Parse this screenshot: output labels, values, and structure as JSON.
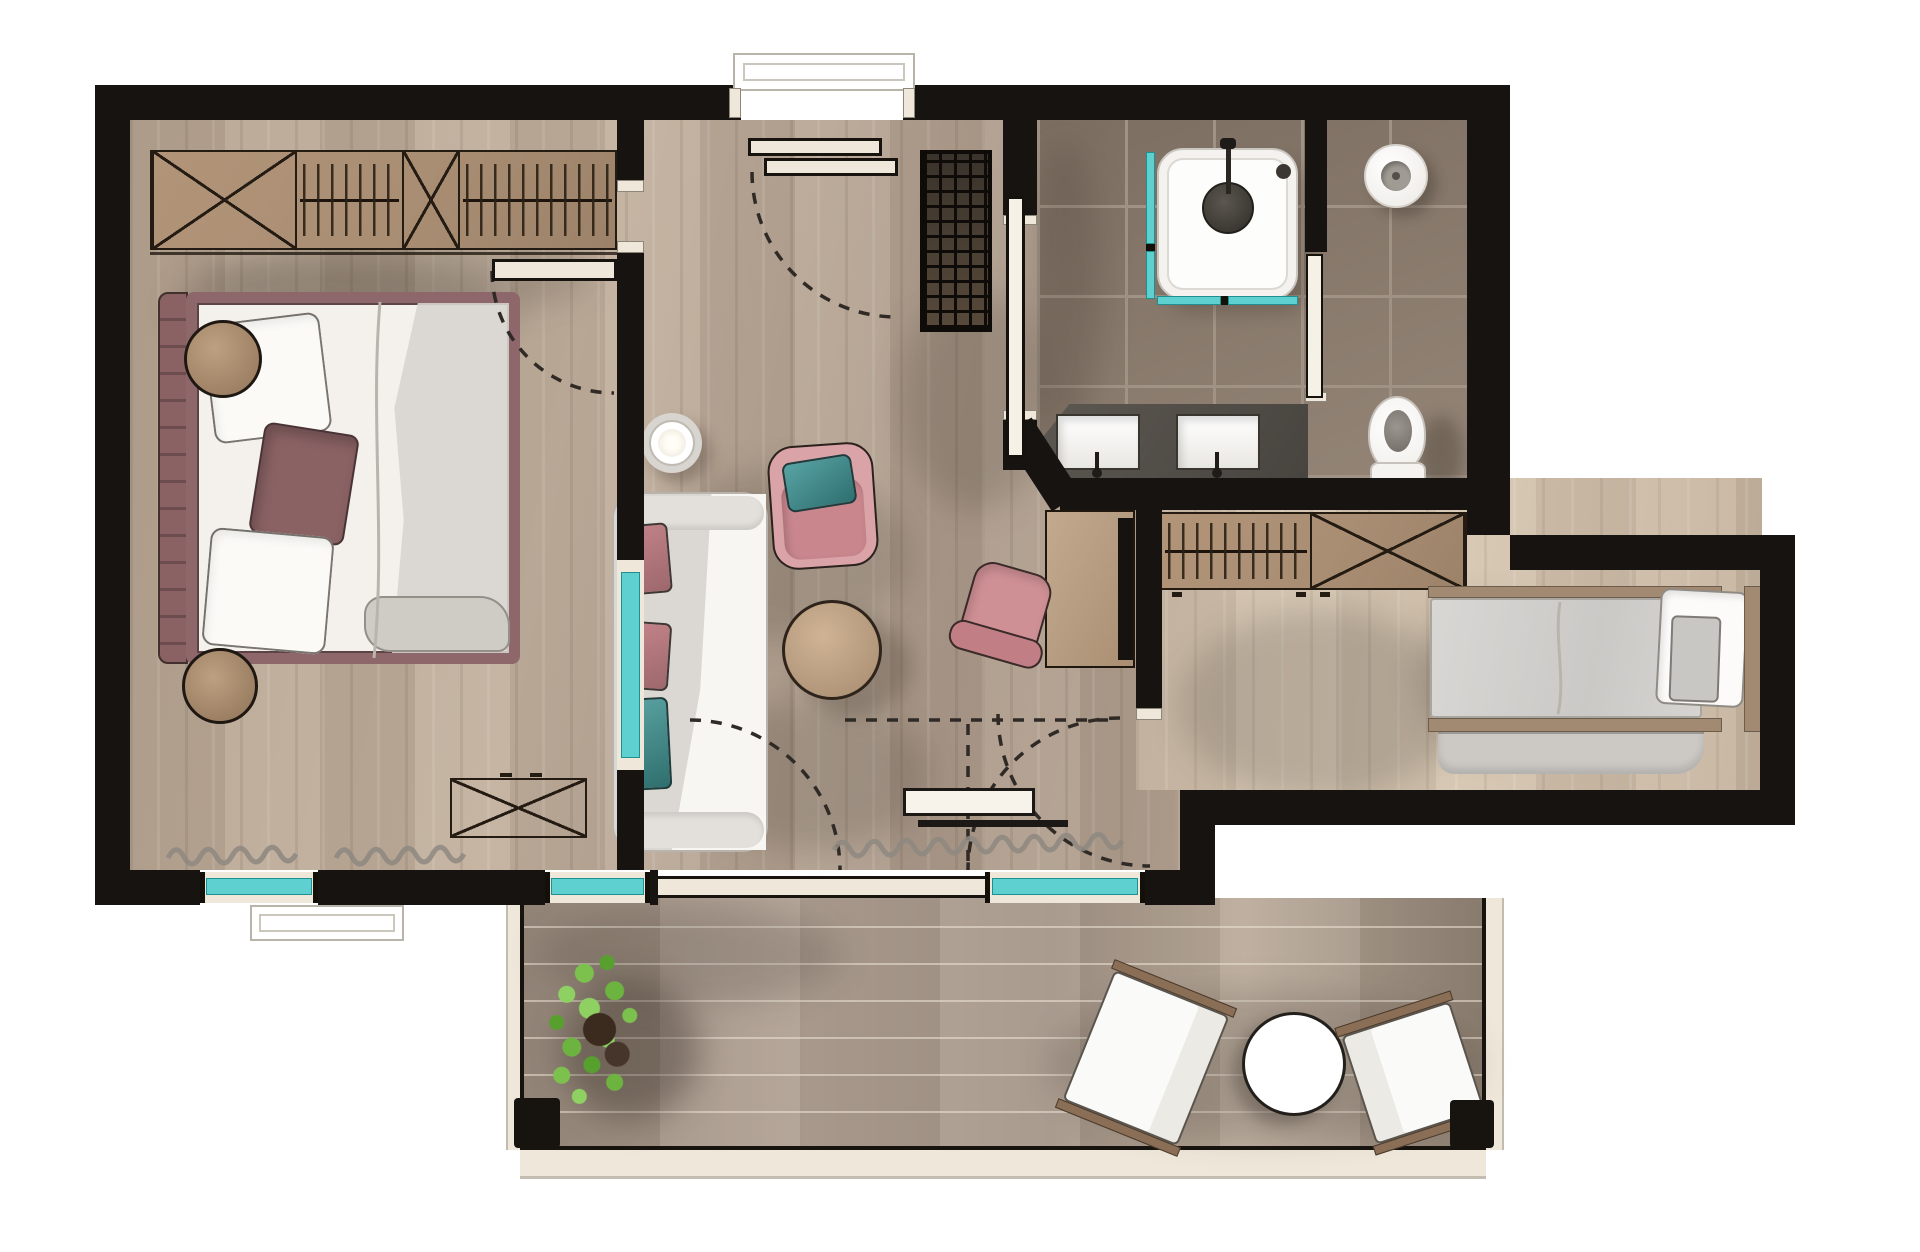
{
  "document": {
    "kind": "architectural floor plan rendering",
    "view": "top-down",
    "style": "hand-drawn watercolor sketch",
    "visible_text": ""
  },
  "palette": {
    "wall": "#171310",
    "outline": "#241c13",
    "cream": "#efe8da",
    "teal": "#5ed0d0",
    "woodFloor": "#b4a190",
    "woodFloorLight": "#cdbda9",
    "deck": "#a29386",
    "tile": "#8d7d6e",
    "tileGrout": "#a09284",
    "tan": "#aa8f75",
    "tanDark": "#8a6f56",
    "maroon": "#8a6264",
    "pink": "#d9a2a8",
    "pinkDeep": "#cf9095",
    "tealCushion": "#44898a",
    "whiteFabric": "#f7f6f3",
    "grayFabric": "#d8d5d0",
    "counterGray": "#56514b",
    "plantGreen": "#6cb94a"
  },
  "plan": {
    "rooms": [
      {
        "name": "master-bedroom",
        "floor": "wood",
        "items": [
          "wardrobe with shelves and hanger rods",
          "double bed with maroon frame",
          "white pillows",
          "maroon accent pillow",
          "round bedside stool top",
          "round bedside stool bottom",
          "dresser with X front",
          "curtain",
          "teal window"
        ]
      },
      {
        "name": "entry-hall",
        "floor": "wood",
        "items": [
          "entry door with swing arc",
          "floor grate"
        ]
      },
      {
        "name": "living-room",
        "floor": "wood",
        "items": [
          "pendant ring lamp",
          "sofa with chaise",
          "pink cushion",
          "pink cushion",
          "teal cushion",
          "round coffee table",
          "pink armchair with teal cushion",
          "desk",
          "tv on desk",
          "pink swivel desk chair",
          "sliding terrace door",
          "teal windows",
          "curtain"
        ]
      },
      {
        "name": "bathroom",
        "floor": "tile",
        "items": [
          "walk-in shower with teal glass",
          "shower drain",
          "hand shower",
          "double vanity with two sinks",
          "sliding door"
        ]
      },
      {
        "name": "wc",
        "floor": "tile",
        "items": [
          "toilet",
          "round wash basin",
          "sliding door"
        ]
      },
      {
        "name": "hallway",
        "floor": "wood",
        "items": [
          "open wardrobe with hanger rod",
          "cabinet with X front"
        ]
      },
      {
        "name": "second-bedroom",
        "floor": "wood",
        "items": [
          "single bed",
          "white pillow",
          "gray cushion",
          "draped blanket"
        ]
      },
      {
        "name": "terrace",
        "floor": "deck",
        "items": [
          "potted plant",
          "lounge chair left",
          "round outdoor table",
          "lounge chair right",
          "corner post left",
          "corner post right",
          "railing"
        ]
      }
    ],
    "door_swing_arcs": 5,
    "sliding_doors": 3,
    "teal_windows": 5
  }
}
